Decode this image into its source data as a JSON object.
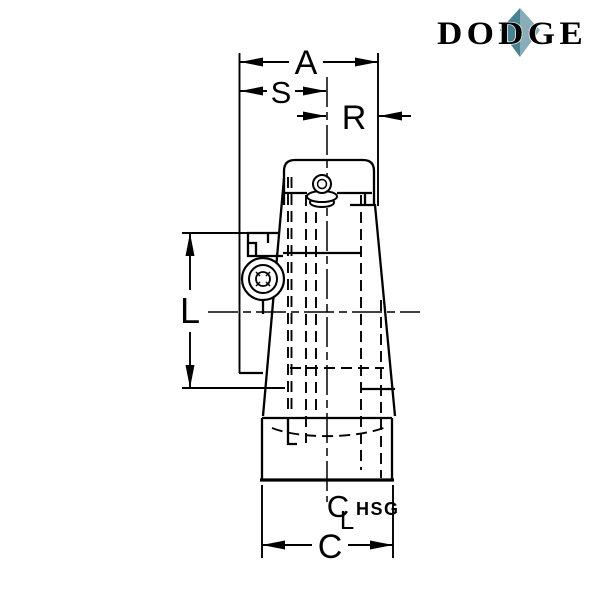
{
  "logo": {
    "text": "DODGE",
    "color": "#295f70",
    "diamond_left": "#4a8191",
    "diamond_right": "#88adb8"
  },
  "dims": {
    "a": {
      "label": "A"
    },
    "s": {
      "label": "S"
    },
    "r": {
      "label": "R"
    },
    "l": {
      "label": "L"
    },
    "c": {
      "label": "C"
    },
    "centerline": {
      "c": "C",
      "l": "L",
      "suffix": "HSG"
    }
  },
  "drawing": {
    "background": "#ffffff",
    "line_color": "#000000"
  }
}
